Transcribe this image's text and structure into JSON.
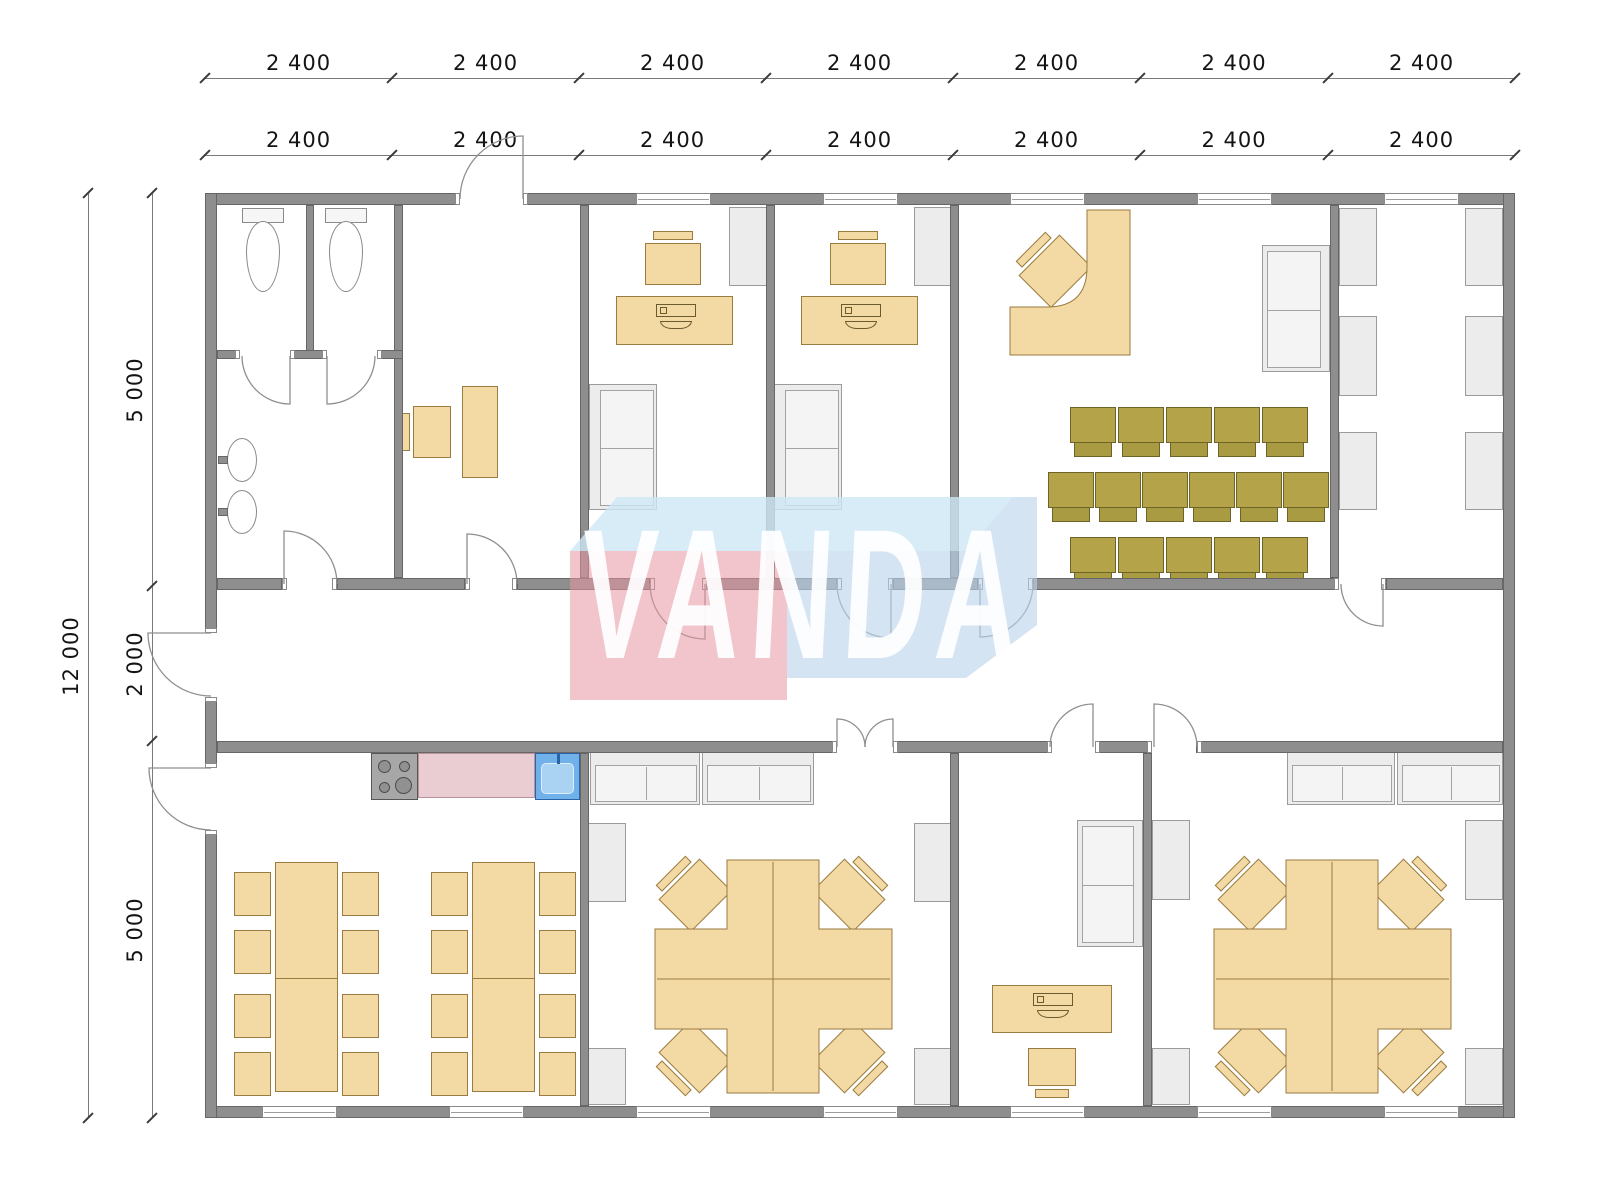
{
  "watermark": {
    "text": "VANDA"
  },
  "dims": {
    "top": [
      {
        "y": 78,
        "ticks": [
          205,
          392,
          579,
          766,
          953,
          1140,
          1328,
          1515
        ],
        "labels": [
          "2 400",
          "2 400",
          "2 400",
          "2 400",
          "2 400",
          "2 400",
          "2 400"
        ]
      },
      {
        "y": 155,
        "ticks": [
          205,
          392,
          579,
          766,
          953,
          1140,
          1328,
          1515
        ],
        "labels": [
          "2 400",
          "2 400",
          "2 400",
          "2 400",
          "2 400",
          "2 400",
          "2 400"
        ]
      }
    ],
    "left": [
      {
        "x": 88,
        "ticks": [
          193,
          1118
        ],
        "labels": [
          "12 000"
        ]
      },
      {
        "x": 152,
        "ticks": [
          193,
          586,
          741,
          1118
        ],
        "labels": [
          "5 000",
          "2 000",
          "5 000"
        ]
      }
    ]
  },
  "plan": {
    "walls": [
      [
        205,
        193,
        255,
        12
      ],
      [
        523,
        193,
        992,
        12
      ],
      [
        205,
        1106,
        1310,
        12
      ],
      [
        205,
        193,
        12,
        440
      ],
      [
        205,
        697,
        12,
        71
      ],
      [
        205,
        830,
        12,
        288
      ],
      [
        1503,
        193,
        12,
        925
      ],
      [
        394,
        205,
        9,
        373
      ],
      [
        580,
        205,
        9,
        373
      ],
      [
        766,
        205,
        9,
        373
      ],
      [
        950,
        205,
        9,
        373
      ],
      [
        1330,
        205,
        9,
        373
      ],
      [
        306,
        205,
        8,
        150
      ],
      [
        217,
        350,
        23,
        9
      ],
      [
        290,
        350,
        37,
        9
      ],
      [
        377,
        350,
        26,
        9
      ],
      [
        217,
        578,
        65,
        12
      ],
      [
        337,
        578,
        128,
        12
      ],
      [
        517,
        578,
        133,
        12
      ],
      [
        707,
        578,
        130,
        12
      ],
      [
        893,
        578,
        85,
        12
      ],
      [
        1033,
        578,
        306,
        12
      ],
      [
        1386,
        578,
        117,
        12
      ],
      [
        217,
        741,
        620,
        12
      ],
      [
        893,
        741,
        159,
        12
      ],
      [
        1095,
        741,
        57,
        12
      ],
      [
        1196,
        741,
        307,
        12
      ],
      [
        580,
        753,
        9,
        353
      ],
      [
        950,
        753,
        9,
        353
      ],
      [
        1143,
        753,
        9,
        353
      ]
    ],
    "caps": [
      [
        455,
        193,
        5,
        12
      ],
      [
        523,
        193,
        5,
        12
      ],
      [
        205,
        628,
        12,
        5
      ],
      [
        205,
        697,
        12,
        5
      ],
      [
        205,
        763,
        12,
        5
      ],
      [
        205,
        830,
        12,
        5
      ],
      [
        282,
        578,
        5,
        12
      ],
      [
        332,
        578,
        5,
        12
      ],
      [
        465,
        578,
        5,
        12
      ],
      [
        512,
        578,
        5,
        12
      ],
      [
        650,
        578,
        5,
        12
      ],
      [
        702,
        578,
        5,
        12
      ],
      [
        837,
        578,
        5,
        12
      ],
      [
        888,
        578,
        5,
        12
      ],
      [
        978,
        578,
        5,
        12
      ],
      [
        1028,
        578,
        5,
        12
      ],
      [
        1334,
        578,
        5,
        12
      ],
      [
        1381,
        578,
        5,
        12
      ],
      [
        832,
        741,
        5,
        12
      ],
      [
        893,
        741,
        5,
        12
      ],
      [
        1047,
        741,
        5,
        12
      ],
      [
        1095,
        741,
        5,
        12
      ],
      [
        1147,
        741,
        5,
        12
      ],
      [
        1197,
        741,
        5,
        12
      ],
      [
        235,
        350,
        5,
        9
      ],
      [
        290,
        350,
        5,
        9
      ],
      [
        322,
        350,
        5,
        9
      ],
      [
        377,
        350,
        5,
        9
      ]
    ],
    "windows": [
      [
        636,
        193,
        75,
        12
      ],
      [
        823,
        193,
        75,
        12
      ],
      [
        1010,
        193,
        75,
        12
      ],
      [
        1197,
        193,
        75,
        12
      ],
      [
        1384,
        193,
        75,
        12
      ],
      [
        262,
        1106,
        75,
        12
      ],
      [
        449,
        1106,
        75,
        12
      ],
      [
        636,
        1106,
        75,
        12
      ],
      [
        823,
        1106,
        75,
        12
      ],
      [
        1010,
        1106,
        75,
        12
      ],
      [
        1197,
        1106,
        75,
        12
      ],
      [
        1384,
        1106,
        75,
        12
      ]
    ],
    "doors": [
      "M523 199 L523 136 A63 63 0 0 0 460 199",
      "M211 633 L148 633 A63 63 0 0 0 211 696",
      "M211 768 L149 768 A62 62 0 0 0 211 830",
      "M284 584 L284 531 A53 53 0 0 1 337 584",
      "M467 584 L467 534 A50 50 0 0 1 517 584",
      "M705 584 L705 639 A55 55 0 0 1 650 584",
      "M891 584 L891 638 A54 54 0 0 1 837 584",
      "M980 584 L980 637 A53 53 0 0 0 1033 584",
      "M1383 584 L1383 626 A42 42 0 0 1 1341 584",
      "M837 747 L837 719 A28 28 0 0 1 865 747",
      "M893 747 L893 719 A28 28 0 0 0 865 747",
      "M1093 747 L1093 704 A43 43 0 0 0 1050 747",
      "M1154 747 L1154 704 A43 43 0 0 1 1197 747",
      "M290 356 L290 404 A48 48 0 0 1 242 356",
      "M327 356 L327 404 A48 48 0 0 0 375 356"
    ],
    "shapes": [
      {
        "cls": "tanfill",
        "d": "M1010 307 L1047 307 Q1087 307 1087 267 L1087 210 L1130 210 L1130 355 L1010 355 Z"
      },
      {
        "cls": "tanfill",
        "d": "M727 860 H819 V929 H892 V1029 H819 V1093 H727 V1029 H655 V929 H727 Z"
      },
      {
        "cls": "tanline",
        "d": "M773 862 V1091"
      },
      {
        "cls": "tanline",
        "d": "M657 979 H890"
      },
      {
        "cls": "tanfill",
        "d": "M1286 860 H1378 V929 H1451 V1029 H1378 V1093 H1286 V1029 H1214 V929 H1286 Z"
      },
      {
        "cls": "tanline",
        "d": "M1332 862 V1091"
      },
      {
        "cls": "tanline",
        "d": "M1216 979 H1449"
      }
    ],
    "watermark_shapes": [
      {
        "cls": "wm-top",
        "d": "M617 497 L1013 497 L966 551 L570 551 Z"
      },
      {
        "cls": "wm-pink",
        "d": "M570 551 L787 551 L787 700 L570 700 Z"
      },
      {
        "cls": "wm-blue",
        "d": "M787 551 L966 551 L1013 497 L1037 497 L1037 625 L966 678 L787 678 Z"
      }
    ],
    "furniture": [
      {
        "t": "toilet",
        "x": 238,
        "y": 208,
        "w": 50,
        "h": 84
      },
      {
        "t": "toilet",
        "x": 321,
        "y": 208,
        "w": 50,
        "h": 84
      },
      {
        "t": "sink",
        "x": 218,
        "y": 436,
        "w": 40,
        "h": 48
      },
      {
        "t": "sink",
        "x": 218,
        "y": 488,
        "w": 40,
        "h": 48
      },
      {
        "t": "chair",
        "x": 401,
        "y": 406,
        "w": 50,
        "h": 52,
        "back": "w"
      },
      {
        "t": "rect-tan",
        "x": 462,
        "y": 386,
        "w": 36,
        "h": 92
      },
      {
        "t": "chair",
        "x": 645,
        "y": 231,
        "w": 56,
        "h": 54,
        "back": "n"
      },
      {
        "t": "deskpc",
        "x": 616,
        "y": 296,
        "w": 117,
        "h": 49
      },
      {
        "t": "cab",
        "x": 729,
        "y": 207,
        "w": 38,
        "h": 79
      },
      {
        "t": "sofa",
        "x": 589,
        "y": 384,
        "w": 68,
        "h": 126,
        "back": "w"
      },
      {
        "t": "chair",
        "x": 830,
        "y": 231,
        "w": 56,
        "h": 54,
        "back": "n"
      },
      {
        "t": "deskpc",
        "x": 801,
        "y": 296,
        "w": 117,
        "h": 49
      },
      {
        "t": "cab",
        "x": 914,
        "y": 207,
        "w": 38,
        "h": 79
      },
      {
        "t": "sofa",
        "x": 774,
        "y": 384,
        "w": 68,
        "h": 126,
        "back": "w"
      },
      {
        "t": "chair",
        "x": 1022,
        "y": 238,
        "w": 58,
        "h": 58,
        "back": "n",
        "rot": -45
      },
      {
        "t": "pc",
        "x": 1078,
        "y": 300,
        "w": 44,
        "h": 30,
        "rot": -45
      },
      {
        "t": "sofa",
        "x": 1262,
        "y": 245,
        "w": 68,
        "h": 127,
        "back": "e"
      },
      {
        "t": "ochair",
        "x": 1070,
        "y": 407,
        "w": 46,
        "h": 50
      },
      {
        "t": "ochair",
        "x": 1118,
        "y": 407,
        "w": 46,
        "h": 50
      },
      {
        "t": "ochair",
        "x": 1166,
        "y": 407,
        "w": 46,
        "h": 50
      },
      {
        "t": "ochair",
        "x": 1214,
        "y": 407,
        "w": 46,
        "h": 50
      },
      {
        "t": "ochair",
        "x": 1262,
        "y": 407,
        "w": 46,
        "h": 50
      },
      {
        "t": "ochair",
        "x": 1048,
        "y": 472,
        "w": 46,
        "h": 50
      },
      {
        "t": "ochair",
        "x": 1095,
        "y": 472,
        "w": 46,
        "h": 50
      },
      {
        "t": "ochair",
        "x": 1142,
        "y": 472,
        "w": 46,
        "h": 50
      },
      {
        "t": "ochair",
        "x": 1189,
        "y": 472,
        "w": 46,
        "h": 50
      },
      {
        "t": "ochair",
        "x": 1236,
        "y": 472,
        "w": 46,
        "h": 50
      },
      {
        "t": "ochair",
        "x": 1283,
        "y": 472,
        "w": 46,
        "h": 50
      },
      {
        "t": "ochair",
        "x": 1070,
        "y": 537,
        "w": 46,
        "h": 50
      },
      {
        "t": "ochair",
        "x": 1118,
        "y": 537,
        "w": 46,
        "h": 50
      },
      {
        "t": "ochair",
        "x": 1166,
        "y": 537,
        "w": 46,
        "h": 50
      },
      {
        "t": "ochair",
        "x": 1214,
        "y": 537,
        "w": 46,
        "h": 50
      },
      {
        "t": "ochair",
        "x": 1262,
        "y": 537,
        "w": 46,
        "h": 50
      },
      {
        "t": "cab",
        "x": 1339,
        "y": 208,
        "w": 38,
        "h": 78
      },
      {
        "t": "cab",
        "x": 1339,
        "y": 316,
        "w": 38,
        "h": 80
      },
      {
        "t": "cab",
        "x": 1339,
        "y": 432,
        "w": 38,
        "h": 78
      },
      {
        "t": "cab",
        "x": 1465,
        "y": 208,
        "w": 38,
        "h": 78
      },
      {
        "t": "cab",
        "x": 1465,
        "y": 316,
        "w": 38,
        "h": 80
      },
      {
        "t": "cab",
        "x": 1465,
        "y": 432,
        "w": 38,
        "h": 78
      },
      {
        "t": "stove",
        "x": 371,
        "y": 753,
        "w": 47,
        "h": 47
      },
      {
        "t": "counter",
        "x": 418,
        "y": 753,
        "w": 117,
        "h": 45
      },
      {
        "t": "ksink",
        "x": 535,
        "y": 753,
        "w": 45,
        "h": 47
      },
      {
        "t": "table",
        "x": 275,
        "y": 862,
        "w": 63,
        "h": 230
      },
      {
        "t": "table",
        "x": 472,
        "y": 862,
        "w": 63,
        "h": 230
      },
      {
        "t": "rect-tan",
        "x": 234,
        "y": 872,
        "w": 37,
        "h": 44
      },
      {
        "t": "rect-tan",
        "x": 234,
        "y": 930,
        "w": 37,
        "h": 44
      },
      {
        "t": "rect-tan",
        "x": 234,
        "y": 994,
        "w": 37,
        "h": 44
      },
      {
        "t": "rect-tan",
        "x": 234,
        "y": 1052,
        "w": 37,
        "h": 44
      },
      {
        "t": "rect-tan",
        "x": 342,
        "y": 872,
        "w": 37,
        "h": 44
      },
      {
        "t": "rect-tan",
        "x": 342,
        "y": 930,
        "w": 37,
        "h": 44
      },
      {
        "t": "rect-tan",
        "x": 342,
        "y": 994,
        "w": 37,
        "h": 44
      },
      {
        "t": "rect-tan",
        "x": 342,
        "y": 1052,
        "w": 37,
        "h": 44
      },
      {
        "t": "rect-tan",
        "x": 431,
        "y": 872,
        "w": 37,
        "h": 44
      },
      {
        "t": "rect-tan",
        "x": 431,
        "y": 930,
        "w": 37,
        "h": 44
      },
      {
        "t": "rect-tan",
        "x": 431,
        "y": 994,
        "w": 37,
        "h": 44
      },
      {
        "t": "rect-tan",
        "x": 431,
        "y": 1052,
        "w": 37,
        "h": 44
      },
      {
        "t": "rect-tan",
        "x": 539,
        "y": 872,
        "w": 37,
        "h": 44
      },
      {
        "t": "rect-tan",
        "x": 539,
        "y": 930,
        "w": 37,
        "h": 44
      },
      {
        "t": "rect-tan",
        "x": 539,
        "y": 994,
        "w": 37,
        "h": 44
      },
      {
        "t": "rect-tan",
        "x": 539,
        "y": 1052,
        "w": 37,
        "h": 44
      },
      {
        "t": "sideboard",
        "x": 590,
        "y": 752,
        "w": 110,
        "h": 53
      },
      {
        "t": "sideboard",
        "x": 702,
        "y": 752,
        "w": 112,
        "h": 53
      },
      {
        "t": "sideboard",
        "x": 1287,
        "y": 752,
        "w": 108,
        "h": 53
      },
      {
        "t": "sideboard",
        "x": 1397,
        "y": 752,
        "w": 106,
        "h": 53
      },
      {
        "t": "cab",
        "x": 588,
        "y": 823,
        "w": 38,
        "h": 79
      },
      {
        "t": "cab",
        "x": 588,
        "y": 1048,
        "w": 38,
        "h": 57
      },
      {
        "t": "cab",
        "x": 914,
        "y": 823,
        "w": 38,
        "h": 79
      },
      {
        "t": "cab",
        "x": 914,
        "y": 1048,
        "w": 38,
        "h": 57
      },
      {
        "t": "cab",
        "x": 1152,
        "y": 820,
        "w": 38,
        "h": 80
      },
      {
        "t": "cab",
        "x": 1152,
        "y": 1048,
        "w": 38,
        "h": 57
      },
      {
        "t": "cab",
        "x": 1465,
        "y": 820,
        "w": 38,
        "h": 80
      },
      {
        "t": "cab",
        "x": 1465,
        "y": 1048,
        "w": 38,
        "h": 57
      },
      {
        "t": "chair",
        "x": 662,
        "y": 862,
        "w": 58,
        "h": 58,
        "back": "n",
        "rot": -45
      },
      {
        "t": "chair",
        "x": 824,
        "y": 862,
        "w": 58,
        "h": 58,
        "back": "n",
        "rot": 45
      },
      {
        "t": "chair",
        "x": 662,
        "y": 1032,
        "w": 58,
        "h": 58,
        "back": "n",
        "rot": -135
      },
      {
        "t": "chair",
        "x": 824,
        "y": 1032,
        "w": 58,
        "h": 58,
        "back": "n",
        "rot": 135
      },
      {
        "t": "chair",
        "x": 1221,
        "y": 862,
        "w": 58,
        "h": 58,
        "back": "n",
        "rot": -45
      },
      {
        "t": "chair",
        "x": 1383,
        "y": 862,
        "w": 58,
        "h": 58,
        "back": "n",
        "rot": 45
      },
      {
        "t": "chair",
        "x": 1221,
        "y": 1032,
        "w": 58,
        "h": 58,
        "back": "n",
        "rot": -135
      },
      {
        "t": "chair",
        "x": 1383,
        "y": 1032,
        "w": 58,
        "h": 58,
        "back": "n",
        "rot": 135
      },
      {
        "t": "pc",
        "x": 718,
        "y": 928,
        "w": 44,
        "h": 30,
        "rot": -45
      },
      {
        "t": "pc",
        "x": 784,
        "y": 928,
        "w": 44,
        "h": 30,
        "rot": 45
      },
      {
        "t": "pc",
        "x": 718,
        "y": 996,
        "w": 44,
        "h": 30,
        "rot": -135
      },
      {
        "t": "pc",
        "x": 784,
        "y": 996,
        "w": 44,
        "h": 30,
        "rot": 135
      },
      {
        "t": "pc",
        "x": 1277,
        "y": 928,
        "w": 44,
        "h": 30,
        "rot": -45
      },
      {
        "t": "pc",
        "x": 1343,
        "y": 928,
        "w": 44,
        "h": 30,
        "rot": 45
      },
      {
        "t": "pc",
        "x": 1277,
        "y": 996,
        "w": 44,
        "h": 30,
        "rot": -135
      },
      {
        "t": "pc",
        "x": 1343,
        "y": 996,
        "w": 44,
        "h": 30,
        "rot": 135
      },
      {
        "t": "sofa",
        "x": 1077,
        "y": 820,
        "w": 66,
        "h": 127,
        "back": "e"
      },
      {
        "t": "deskpc",
        "x": 992,
        "y": 985,
        "w": 120,
        "h": 48
      },
      {
        "t": "chair",
        "x": 1028,
        "y": 1048,
        "w": 48,
        "h": 50,
        "back": "s"
      }
    ]
  }
}
